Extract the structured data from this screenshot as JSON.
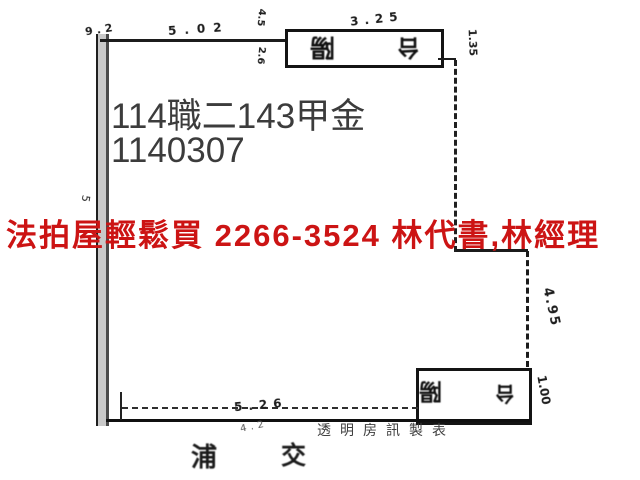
{
  "colors": {
    "advert_red": "#cc1414",
    "case_gray": "#3c3c3c",
    "ink": "#1b1b1b"
  },
  "overlay": {
    "case_line1": "114職二143甲金",
    "case_line2": "1140307",
    "advert": "法拍屋輕鬆買  2266-3524  林代書,林經理"
  },
  "floorplan": {
    "balcony_top": {
      "char1": "陽",
      "char2": "台"
    },
    "balcony_bottom": {
      "char1": "陽",
      "char2": "台"
    },
    "dims": {
      "top_left": "9.2",
      "top_mid": "5.02",
      "top_inner_a": "4.5",
      "top_inner_b": "2.6",
      "top_balcony": "3.25",
      "right_upper": "1.35",
      "right_mid": "4.95",
      "right_lower": "1.00",
      "left_mid": "5",
      "bottom": "5.26",
      "bottom_small": "4.2"
    },
    "street_char_a": "浦",
    "street_char_b": "交"
  },
  "footer": {
    "credit": "透明房訊製表"
  }
}
